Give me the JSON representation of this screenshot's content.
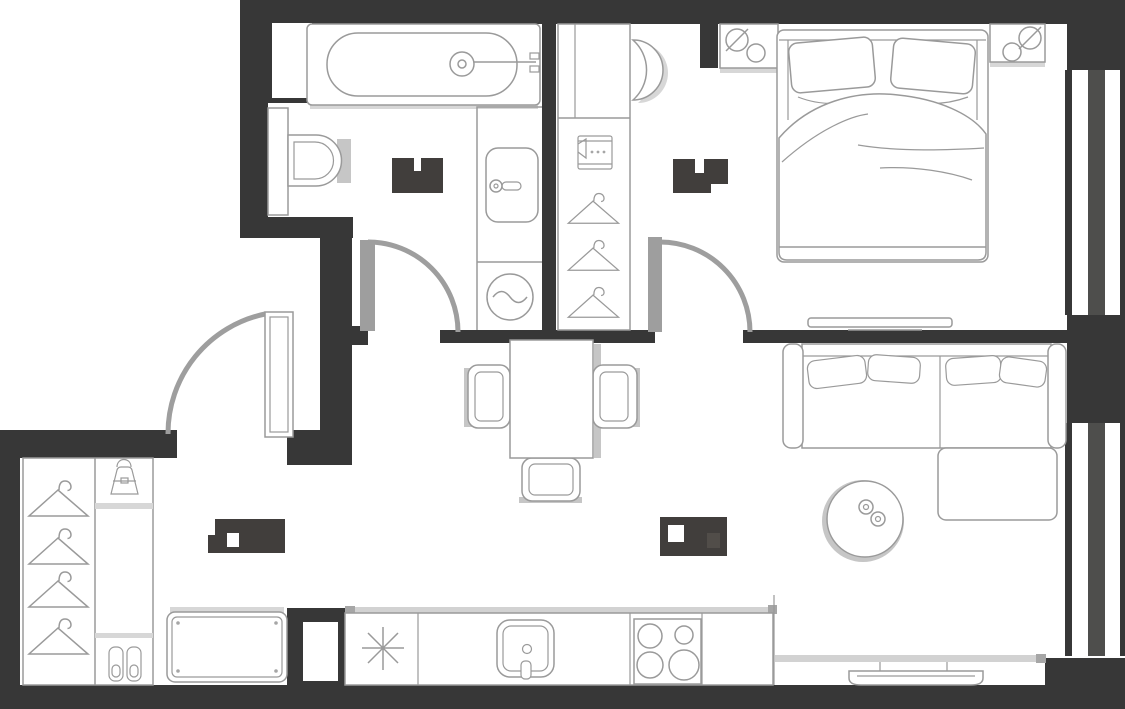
{
  "meta": {
    "description": "Top-down architectural floor plan of a one-bedroom apartment; all four room-area labels are redacted with dark blocks",
    "aria_label": "apartment-floor-plan"
  },
  "colors": {
    "bg": "#ffffff",
    "wall": "#373737",
    "mullion": "#4e4e4c",
    "line": "#9a9a9a",
    "door": "#9e9e9e",
    "shadow": "#d7d7d7",
    "shadow2": "#c6c6c6",
    "redacted": "#413e3c",
    "redacted2": "#514d49",
    "graybar": "#d2d2d2",
    "graycap": "#a6a6a6"
  },
  "rooms": [
    {
      "id": "bathroom",
      "label_redacted": true,
      "fixtures": [
        "bathtub",
        "toilet",
        "washbasin",
        "washing-machine",
        "duct-niche"
      ]
    },
    {
      "id": "bedroom-with-wardrobe",
      "label_redacted": true,
      "fixtures": [
        "double-bed",
        "pillows",
        "nightstand-left",
        "nightstand-right",
        "lamps",
        "tv",
        "wardrobe-cabinet",
        "folded-shirt-shelf",
        "hangers",
        "mirror-crescent"
      ]
    },
    {
      "id": "entry-hall",
      "label_redacted": true,
      "fixtures": [
        "open-wardrobe",
        "hangers",
        "handbag-shelf",
        "shoe-shelf",
        "bench-console"
      ]
    },
    {
      "id": "living-room-kitchen",
      "label_redacted": true,
      "fixtures": [
        "corner-sofa",
        "chaise",
        "coffee-table",
        "media-console",
        "tv",
        "dining-table",
        "chairs",
        "kitchen-counter",
        "fridge-snowflake",
        "kitchen-sink",
        "cooktop-4-burners",
        "duct-shaft"
      ]
    }
  ],
  "doors": [
    "entry-door-swing",
    "bathroom-door-swing",
    "bedroom-door-swing"
  ],
  "windows": [
    "bedroom-window",
    "living-room-window"
  ]
}
